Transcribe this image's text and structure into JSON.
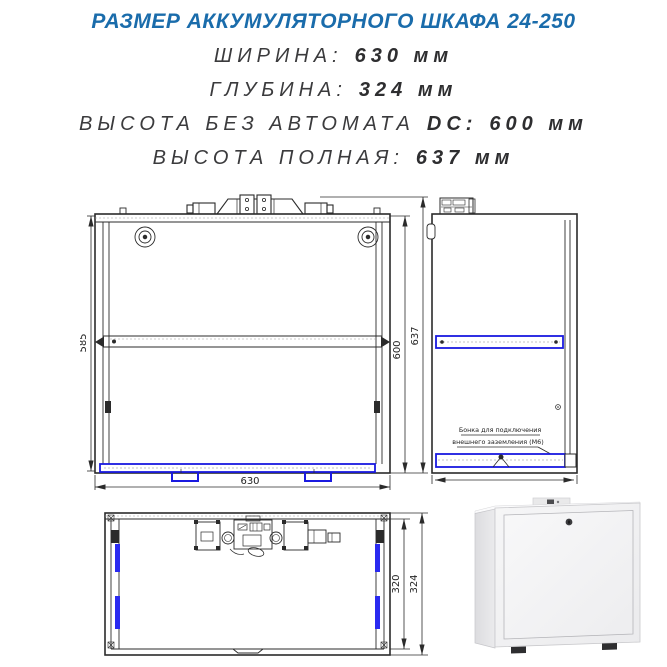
{
  "header": {
    "title": "РАЗМЕР АККУМУЛЯТОРНОГО ШКАФА 24-250",
    "specs": [
      {
        "label": "ШИРИНА:",
        "mid": "",
        "value": "630 мм"
      },
      {
        "label": "ГЛУБИНА:",
        "mid": "",
        "value": "324 мм"
      },
      {
        "label": "ВЫСОТА БЕЗ АВТОМАТА",
        "mid": "DC:",
        "value": "600 мм"
      },
      {
        "label": "ВЫСОТА ПОЛНАЯ:",
        "mid": "",
        "value": "637 мм"
      }
    ]
  },
  "drawings": {
    "front_view": {
      "dim_inner_height": "585",
      "dim_width": "630",
      "dim_body_height": "600",
      "dim_full_height": "637"
    },
    "side_view": {
      "annotation_line1": "Бонка для подключения",
      "annotation_line2": "внешнего заземления (М6)"
    },
    "top_view": {
      "dim_inner_depth": "320",
      "dim_outer_depth": "324"
    }
  },
  "colors": {
    "title_blue": "#1a6cab",
    "drawing_blue": "#1a1ae0",
    "line_color": "#2b2b2b"
  }
}
